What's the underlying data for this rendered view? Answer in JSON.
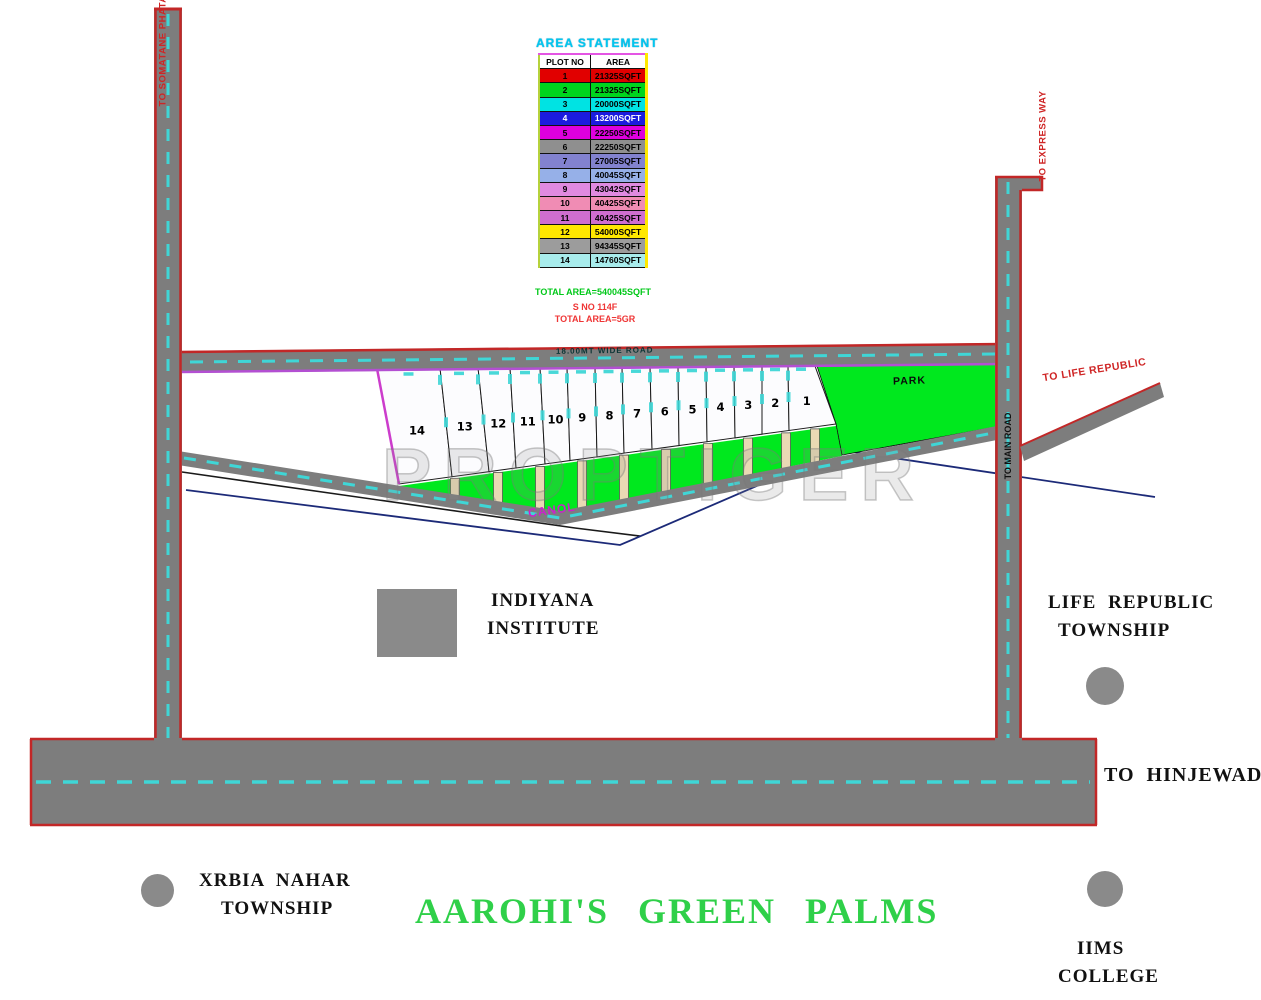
{
  "watermark": "PROPTIGER",
  "title": "AAROHI'S  GREEN  PALMS",
  "area_statement": {
    "title": "AREA STATEMENT",
    "columns": [
      "PLOT NO",
      "AREA"
    ],
    "rows": [
      {
        "plot": "1",
        "area": "21325SQFT",
        "color": "#e10000",
        "text": "#000000"
      },
      {
        "plot": "2",
        "area": "21325SQFT",
        "color": "#00d51e",
        "text": "#000000"
      },
      {
        "plot": "3",
        "area": "20000SQFT",
        "color": "#00e3e3",
        "text": "#000000"
      },
      {
        "plot": "4",
        "area": "13200SQFT",
        "color": "#1b1bde",
        "text": "#ffffff"
      },
      {
        "plot": "5",
        "area": "22250SQFT",
        "color": "#de00de",
        "text": "#000000"
      },
      {
        "plot": "6",
        "area": "22250SQFT",
        "color": "#8f8f8f",
        "text": "#000000"
      },
      {
        "plot": "7",
        "area": "27005SQFT",
        "color": "#8282cf",
        "text": "#000000"
      },
      {
        "plot": "8",
        "area": "40045SQFT",
        "color": "#96b0e8",
        "text": "#000000"
      },
      {
        "plot": "9",
        "area": "43042SQFT",
        "color": "#e08ae0",
        "text": "#000000"
      },
      {
        "plot": "10",
        "area": "40425SQFT",
        "color": "#f08cb4",
        "text": "#000000"
      },
      {
        "plot": "11",
        "area": "40425SQFT",
        "color": "#cf6ecf",
        "text": "#000000"
      },
      {
        "plot": "12",
        "area": "54000SQFT",
        "color": "#ffe800",
        "text": "#000000"
      },
      {
        "plot": "13",
        "area": "94345SQFT",
        "color": "#9c9c9c",
        "text": "#000000"
      },
      {
        "plot": "14",
        "area": "14760SQFT",
        "color": "#a8ecec",
        "text": "#000000"
      }
    ],
    "total_line": "TOTAL AREA=540045SQFT",
    "survey_line1": "S NO 114F",
    "survey_line2": "TOTAL AREA=5GR"
  },
  "map": {
    "plot_numbers": [
      "14",
      "13",
      "12",
      "11",
      "10",
      "9",
      "8",
      "7",
      "6",
      "5",
      "4",
      "3",
      "2",
      "1"
    ],
    "park": "PARK",
    "canal": "CANOL",
    "wide_road": "18.00MT WIDE ROAD",
    "to_somatane": "TO SOMATANE PHATA",
    "to_express": "TO EXPRESS WAY",
    "to_life_republic": "TO LIFE REPUBLIC",
    "to_main_road": "TO MAIN ROAD",
    "to_hinjewadi": "TO HINJEWADI"
  },
  "landmarks": {
    "indiyana_line1": "INDIYANA",
    "indiyana_line2": "INSTITUTE",
    "life_republic_line1": "LIFE  REPUBLIC",
    "life_republic_line2": "TOWNSHIP",
    "xrbia_line1": "XRBIA  NAHAR",
    "xrbia_line2": "TOWNSHIP",
    "iims_line1": "IIMS",
    "iims_line2": "COLLEGE"
  },
  "colors": {
    "road_gray": "#7d7d7d",
    "border_red": "#c22727",
    "dash_cyan": "#3fd6d6",
    "boundary_purple": "#b34fd2",
    "green": "#00e81e",
    "title_green": "#2fd049"
  }
}
